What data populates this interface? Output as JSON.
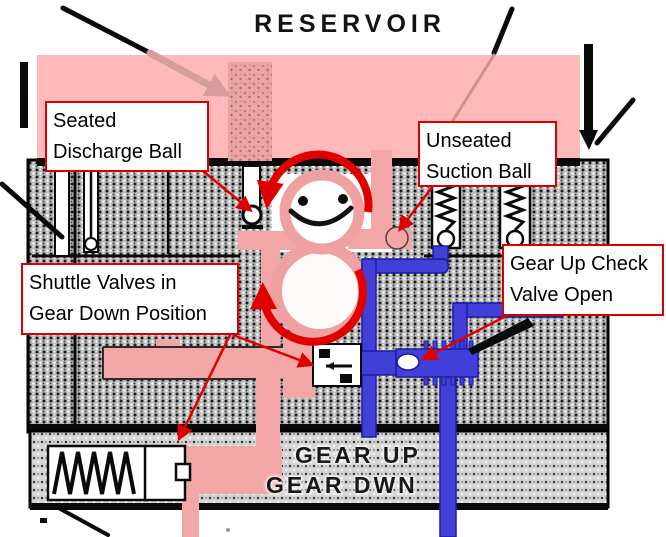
{
  "diagram": {
    "title": "RESERVOIR",
    "labels": {
      "gear_up": "GEAR UP",
      "gear_down": "GEAR DWN"
    },
    "callouts": {
      "seated_discharge": {
        "line1": "Seated",
        "line2": "Discharge Ball"
      },
      "unseated_suction": {
        "line1": "Unseated",
        "line2": "Suction Ball"
      },
      "shuttle_valves": {
        "line1": "Shuttle Valves in",
        "line2": "Gear Down Position"
      },
      "gear_up_check": {
        "line1": "Gear Up Check",
        "line2": "Valve Open"
      }
    },
    "colors": {
      "reservoir_fluid": "#FFB9B9",
      "pressure_fluid": "#F2A6A6",
      "gear_up_line": "#4040D8",
      "annotation_red": "#E10000"
    }
  }
}
